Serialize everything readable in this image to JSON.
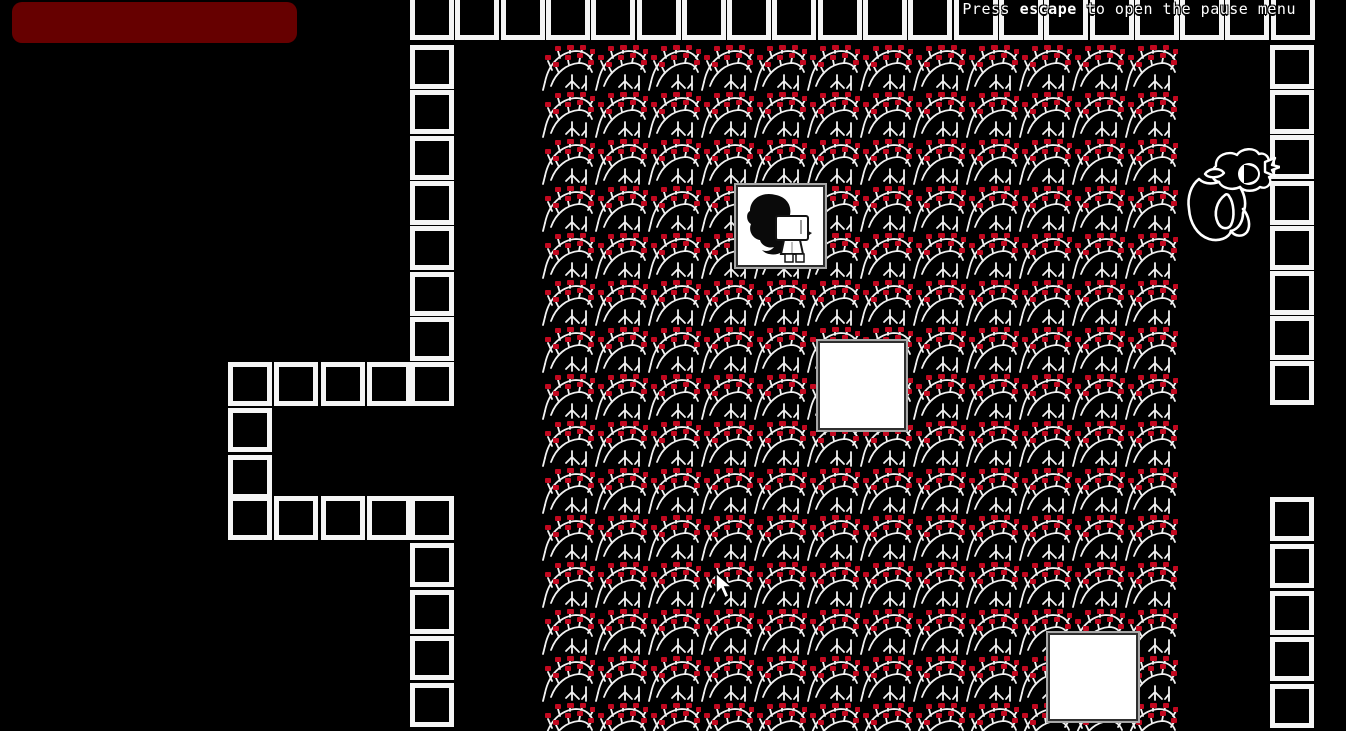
{
  "screen": {
    "width": 1346,
    "height": 731
  },
  "hint": {
    "prefix": "Press ",
    "key": "escape",
    "suffix": " to open the pause menu",
    "full_text": "Press escape to open the pause menu"
  },
  "colors": {
    "background": "#000000",
    "wall": "#f5f5f5",
    "bramble_branch": "#f2f2f2",
    "bramble_berry": "#c2081f",
    "health_bar": "#660000",
    "box_fill": "#ffffff",
    "box_border_dark": "#2f2f2f",
    "box_border_light": "#a8a8a8"
  },
  "map": {
    "tile": {
      "width": 44,
      "height": 44
    },
    "wall_sections": [
      {
        "name": "top-wall-row",
        "x": 410,
        "y": -7,
        "dx": 45.3,
        "dy": 0,
        "count": 20,
        "height": 47
      },
      {
        "name": "left-wall-upper",
        "x": 410,
        "y": 45,
        "dx": 0,
        "dy": 45.3,
        "count": 8
      },
      {
        "name": "left-wall-lower",
        "x": 410,
        "y": 496,
        "dx": 0,
        "dy": 46.8,
        "count": 5
      },
      {
        "name": "right-wall-upper",
        "x": 1270,
        "y": 45,
        "dx": 0,
        "dy": 45.2,
        "count": 8
      },
      {
        "name": "right-wall-lower",
        "x": 1270,
        "y": 497,
        "dx": 0,
        "dy": 46.8,
        "count": 5
      },
      {
        "name": "alcove-top-row",
        "x": 228,
        "y": 362,
        "dx": 46.4,
        "dy": 0,
        "count": 4
      },
      {
        "name": "alcove-left-column",
        "x": 228,
        "y": 408,
        "dx": 0,
        "dy": 46.5,
        "count": 2
      },
      {
        "name": "alcove-bottom-row",
        "x": 228,
        "y": 496,
        "dx": 46.4,
        "dy": 0,
        "count": 4
      }
    ],
    "bramble_field": {
      "x": 542,
      "y": 45,
      "columns": 12,
      "rows": 15,
      "tile_width": 53,
      "tile_height": 47
    }
  },
  "entities": {
    "health-bar": {
      "x": 12,
      "y": 2,
      "width": 285,
      "height": 41
    },
    "player-box": {
      "x": 736,
      "y": 185,
      "width": 89,
      "height": 82
    },
    "white-box-middle": {
      "x": 818,
      "y": 341,
      "width": 88,
      "height": 89
    },
    "white-box-bottom": {
      "x": 1048,
      "y": 633,
      "width": 90,
      "height": 88
    },
    "creature-sprite": {
      "x": 1185,
      "y": 145,
      "width": 95,
      "height": 100
    },
    "mouse-cursor": {
      "x": 714,
      "y": 572,
      "width": 20,
      "height": 28
    }
  }
}
